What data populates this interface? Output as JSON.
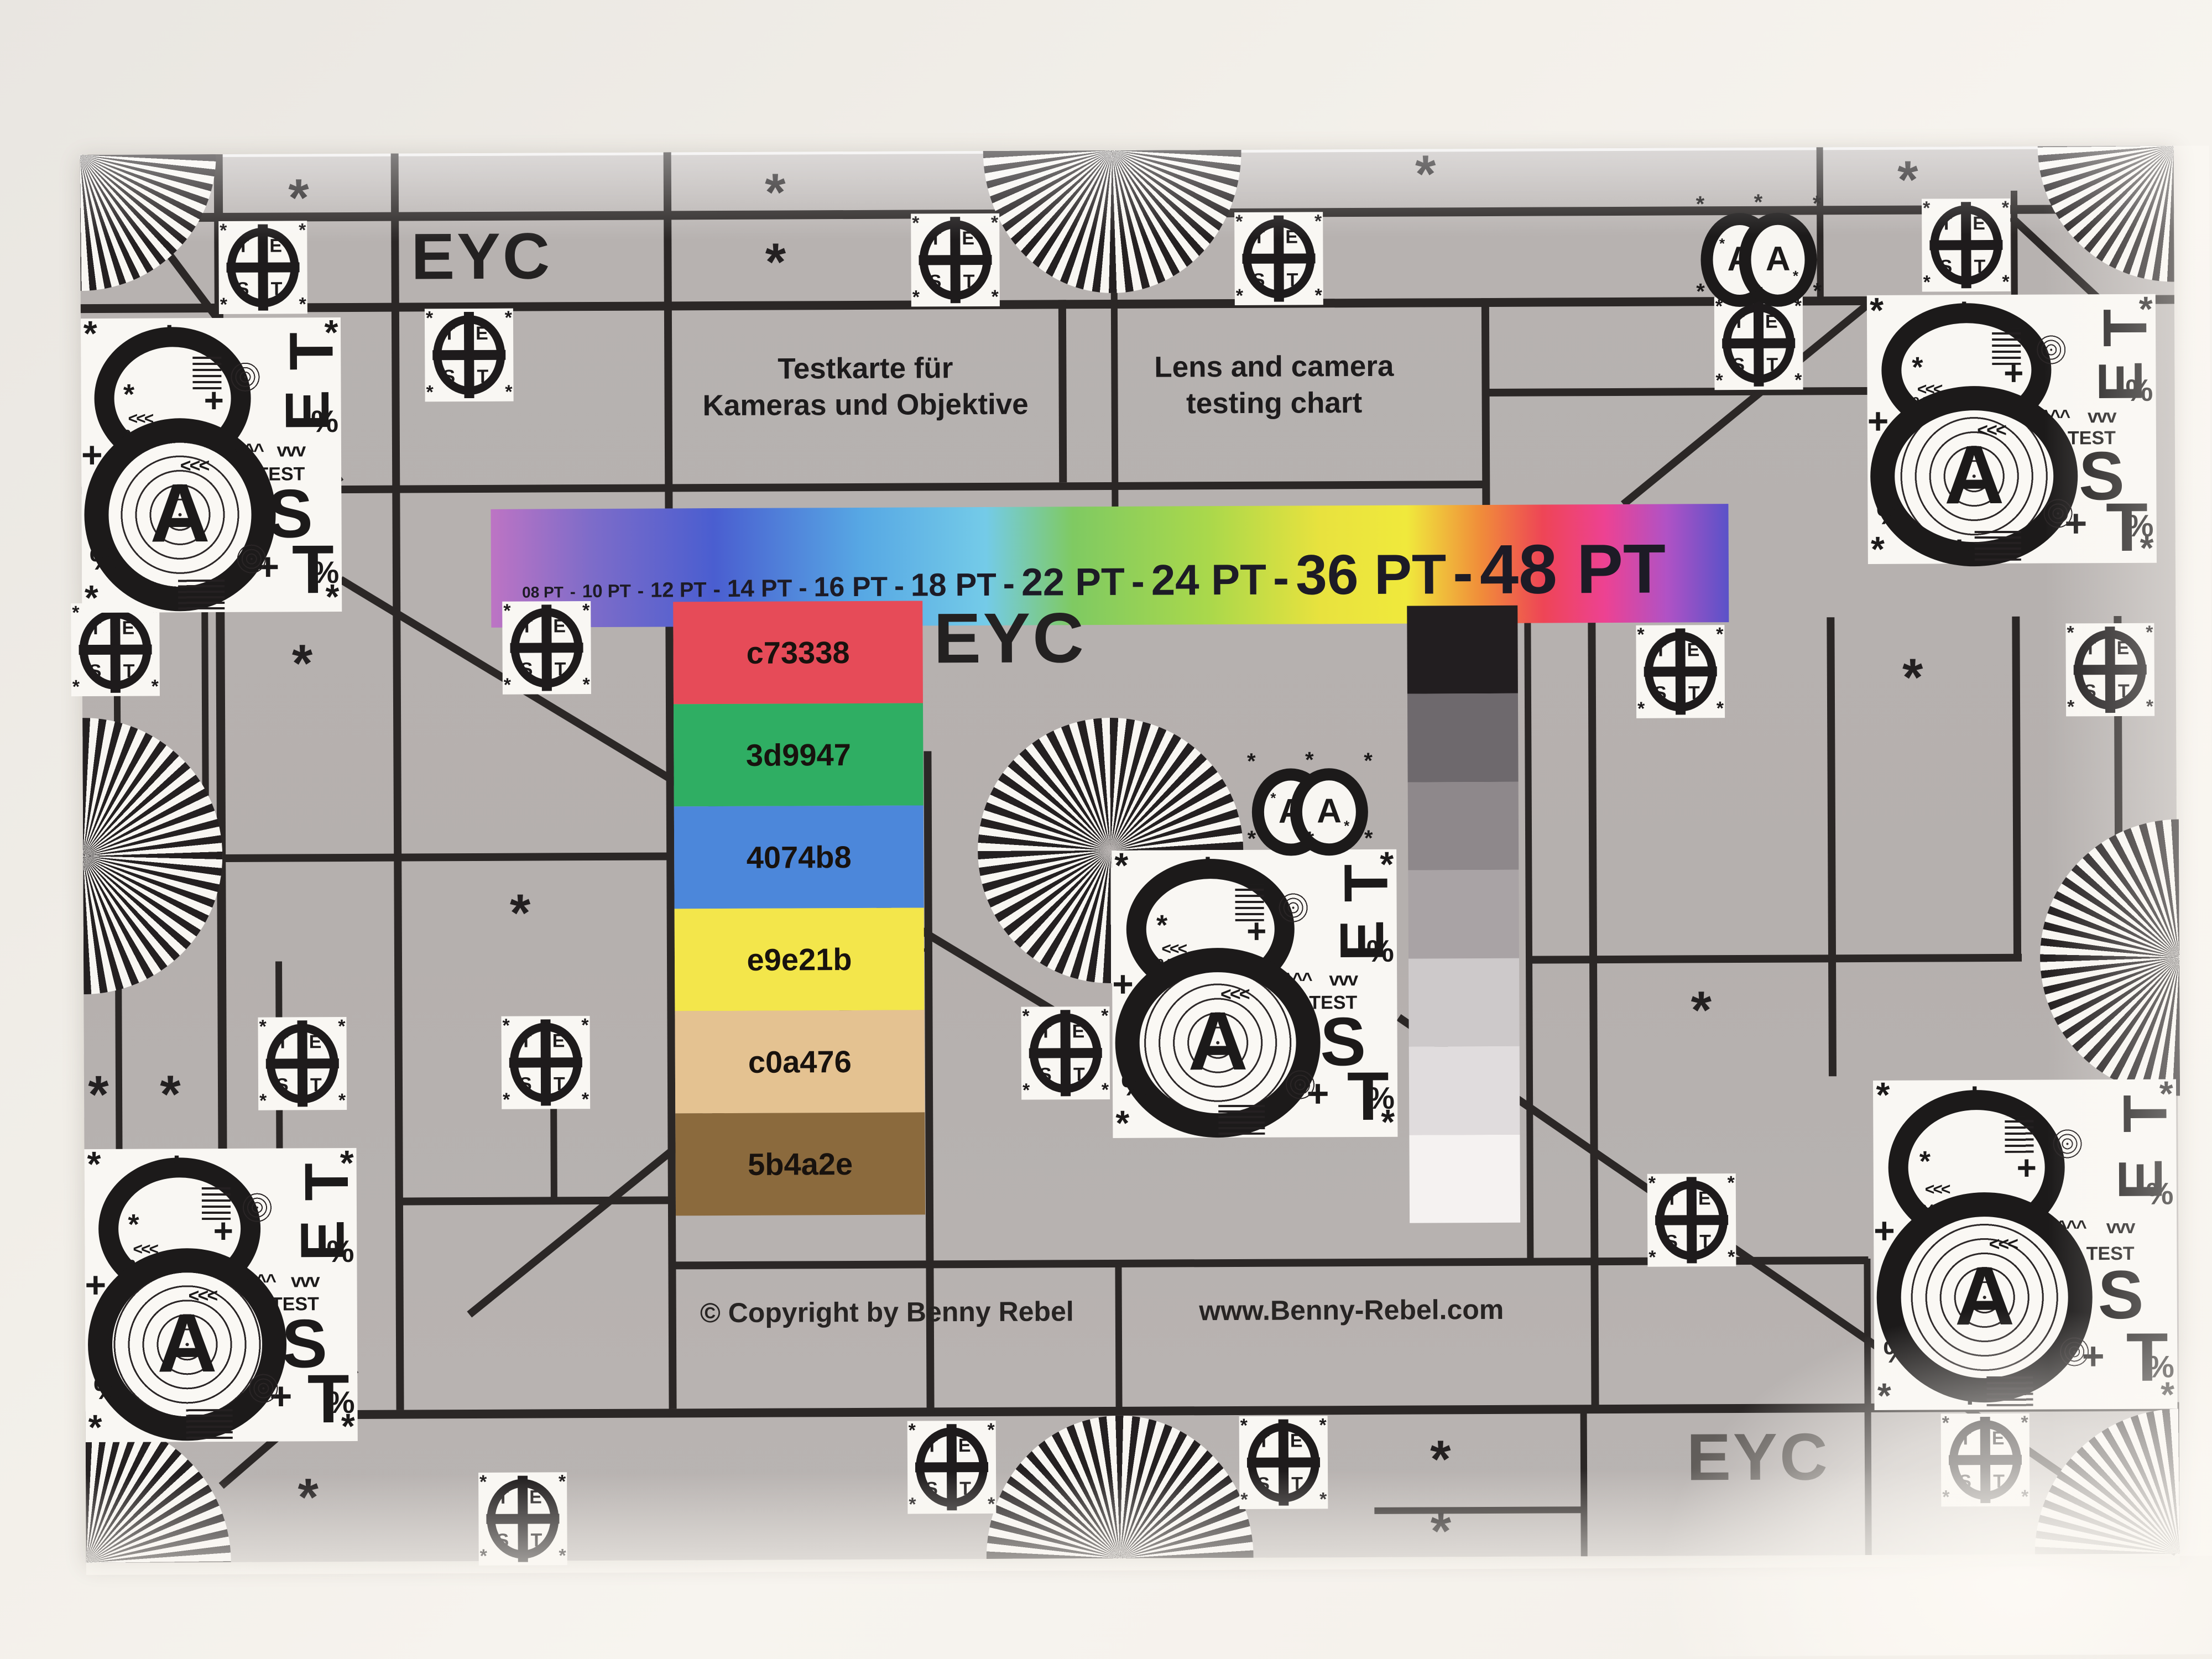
{
  "card": {
    "title_de": [
      "Testkarte für",
      "Kameras und Objektive"
    ],
    "title_en": [
      "Lens and camera",
      "testing chart"
    ],
    "eyc": "EYC",
    "copyright": "© Copyright by Benny Rebel",
    "website": "www.Benny-Rebel.com"
  },
  "pt_scale": {
    "sep": "-",
    "labels": [
      "08 PT",
      "10 PT",
      "12 PT",
      "14 PT",
      "16 PT",
      "18 PT",
      "22 PT",
      "24 PT",
      "36 PT",
      "48 PT"
    ]
  },
  "patches": [
    {
      "label": "c73338",
      "color": "#e64b58"
    },
    {
      "label": "3d9947",
      "color": "#2fae63"
    },
    {
      "label": "4074b8",
      "color": "#4c87da"
    },
    {
      "label": "e9e21b",
      "color": "#f3e64b"
    },
    {
      "label": "c0a476",
      "color": "#e4c291"
    },
    {
      "label": "5b4a2e",
      "color": "#8b6a3d"
    }
  ],
  "grayscale": [
    "#221e20",
    "#6e696d",
    "#8e888b",
    "#a9a3a5",
    "#cdc9ca",
    "#e0dcdd",
    "#f5f2f1"
  ],
  "rainbow": [
    "#bd74c4",
    "#7e6cc9",
    "#4a5ed0",
    "#57a8e4",
    "#74cbe8",
    "#7fca62",
    "#aad84b",
    "#e8e23e",
    "#f0e93c",
    "#f08c3a",
    "#ee4556",
    "#ed4292",
    "#b052c5",
    "#5a52c8"
  ],
  "logo": {
    "t1": "T",
    "e": "E",
    "s": "S",
    "t2": "T"
  },
  "big8": {
    "a": "A",
    "t1": "T",
    "e": "E",
    "s": "S",
    "t2": "T",
    "test": "TEST",
    "chev_left": "<<<",
    "chev_up": "^^^",
    "chev_down": "vvv",
    "plus": "+",
    "percent": "%",
    "ast": "*"
  },
  "twin8": {
    "a": "A",
    "ast": "*"
  },
  "sym": {
    "ast": "*"
  }
}
